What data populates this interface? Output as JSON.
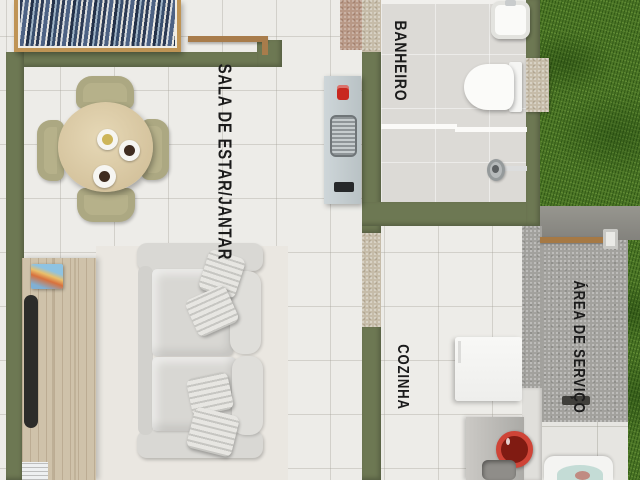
{
  "floorplan": {
    "type": "top-down apartment floor plan render",
    "rooms": [
      {
        "name": "living-dining",
        "label": "SALA DE ESTAR/JANTAR"
      },
      {
        "name": "bathroom",
        "label": "BANHEIRO"
      },
      {
        "name": "kitchen",
        "label": "COZINHA"
      },
      {
        "name": "service-area",
        "label": "ÁREA DE SERVIÇO"
      }
    ],
    "colors": {
      "wall_olive": "#6d7853",
      "grass_green": "#4c7526",
      "floor_tile": "#edece8",
      "bath_floor": "#dcdad6",
      "service_floor": "#a2a19d",
      "wood_furniture": "#cfc2aa",
      "sofa_gray": "#d8d7d3",
      "gas_cylinder_red": "#cf4437",
      "label_text": "#1b1b1b"
    }
  }
}
